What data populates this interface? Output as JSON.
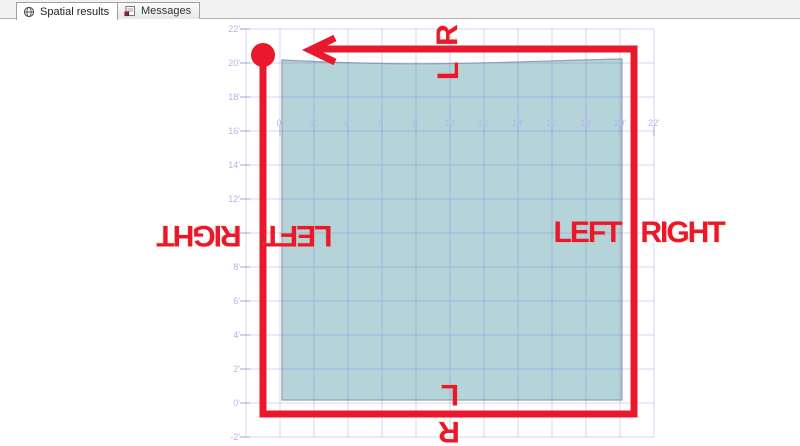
{
  "tabs": [
    {
      "label": "Spatial results",
      "icon": "globe-icon",
      "active": true
    },
    {
      "label": "Messages",
      "icon": "messages-icon",
      "active": false
    }
  ],
  "colors": {
    "annotation_red": "#e9182c",
    "polygon_fill": "#b5d4da",
    "polygon_stroke": "#93a3a8",
    "grid_line": "rgba(112,112,226,0.30)",
    "axis_tick": "#a2a2de",
    "axis_text": "#b3b3ee"
  },
  "chart_data": {
    "type": "spatial-grid",
    "title": "",
    "x_tick_labels": [
      "0'",
      "2'",
      "4'",
      "6'",
      "8'",
      "10'",
      "12'",
      "14'",
      "16'",
      "18'",
      "20'",
      "22'"
    ],
    "y_tick_labels": [
      "22'",
      "20'",
      "18'",
      "16'",
      "14'",
      "12'",
      "10'",
      "8'",
      "6'",
      "4'",
      "2'",
      "0'",
      "-2'"
    ],
    "x_range_ft": [
      -2,
      22
    ],
    "y_range_ft": [
      -2,
      22
    ],
    "grid_step_ft": 2,
    "grid_on": true,
    "polygon": {
      "shape": "square with slightly wavy top edge",
      "x_extent_ft": [
        0,
        20
      ],
      "y_extent_ft": [
        0,
        20
      ]
    }
  },
  "annotations": {
    "top_outer": "R",
    "top_inner": "L",
    "bottom_inner": "L",
    "bottom_outer": "R",
    "right_inner": "LEFT",
    "right_outer": "RIGHT",
    "left_outer": "RIGHT",
    "left_inner": "LEFT",
    "route": "thick red rectangle traced around polygon, counter-clockwise, arrow at top pointing left toward red start dot at top-left corner"
  }
}
